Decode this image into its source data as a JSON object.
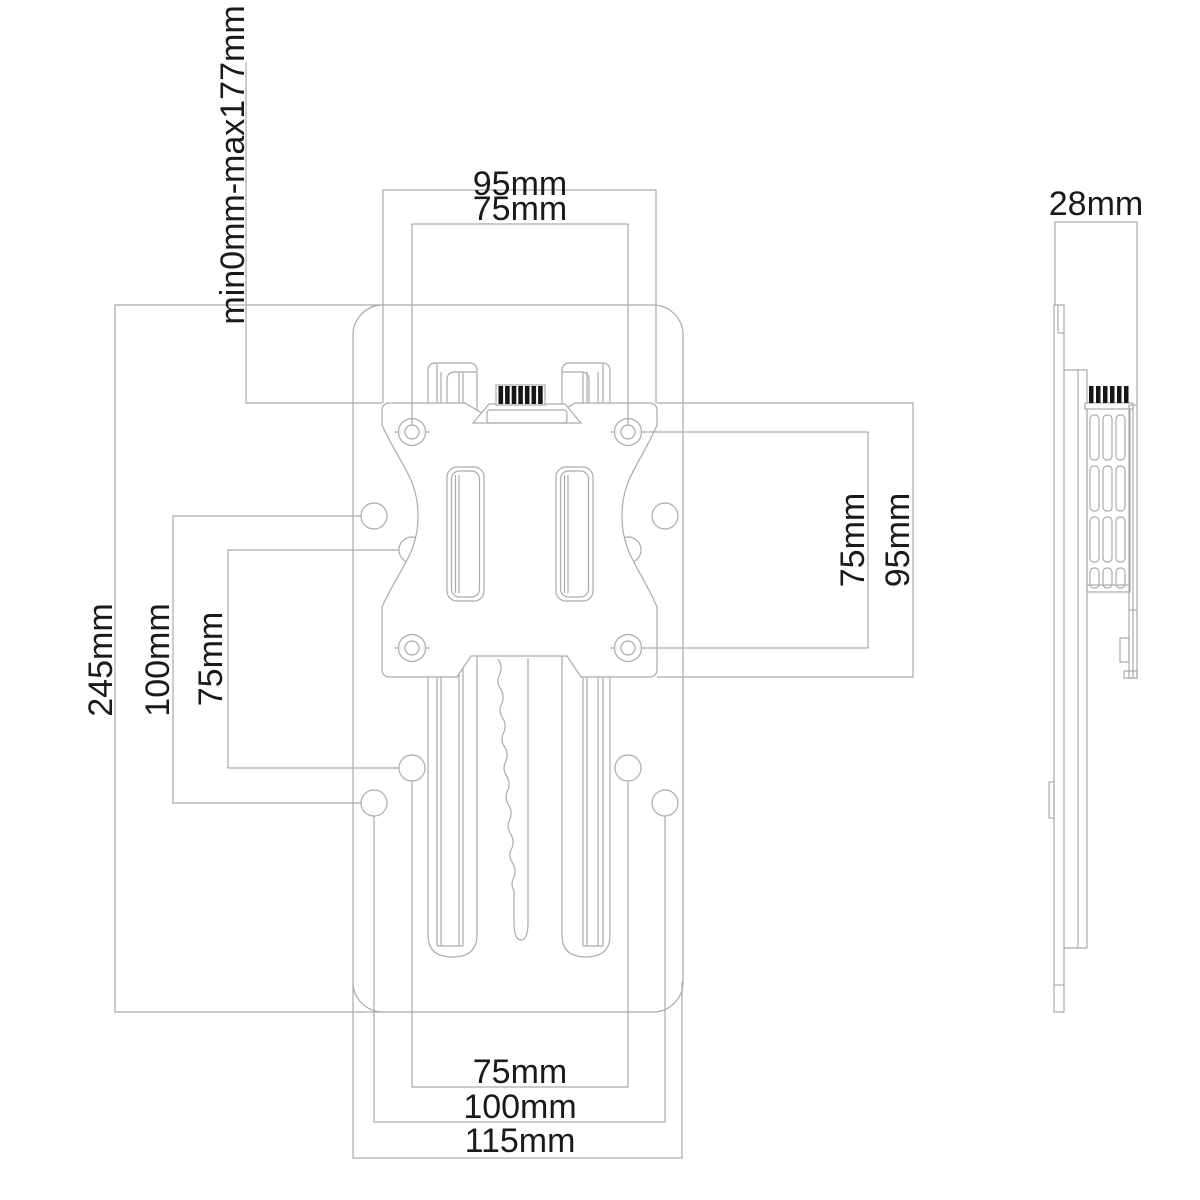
{
  "colors": {
    "line": "#ababab",
    "text": "#1a1a1a",
    "knob": "#161616"
  },
  "dims": {
    "top_outer": "95mm",
    "top_inner": "75mm",
    "slide_range": "min0mm-max177mm",
    "left_total": "245mm",
    "left_outer": "100mm",
    "left_inner": "75mm",
    "right_inner": "75mm",
    "right_outer": "95mm",
    "side_depth": "28mm",
    "bottom_inner": "75mm",
    "bottom_mid": "100mm",
    "bottom_outer": "115mm"
  }
}
